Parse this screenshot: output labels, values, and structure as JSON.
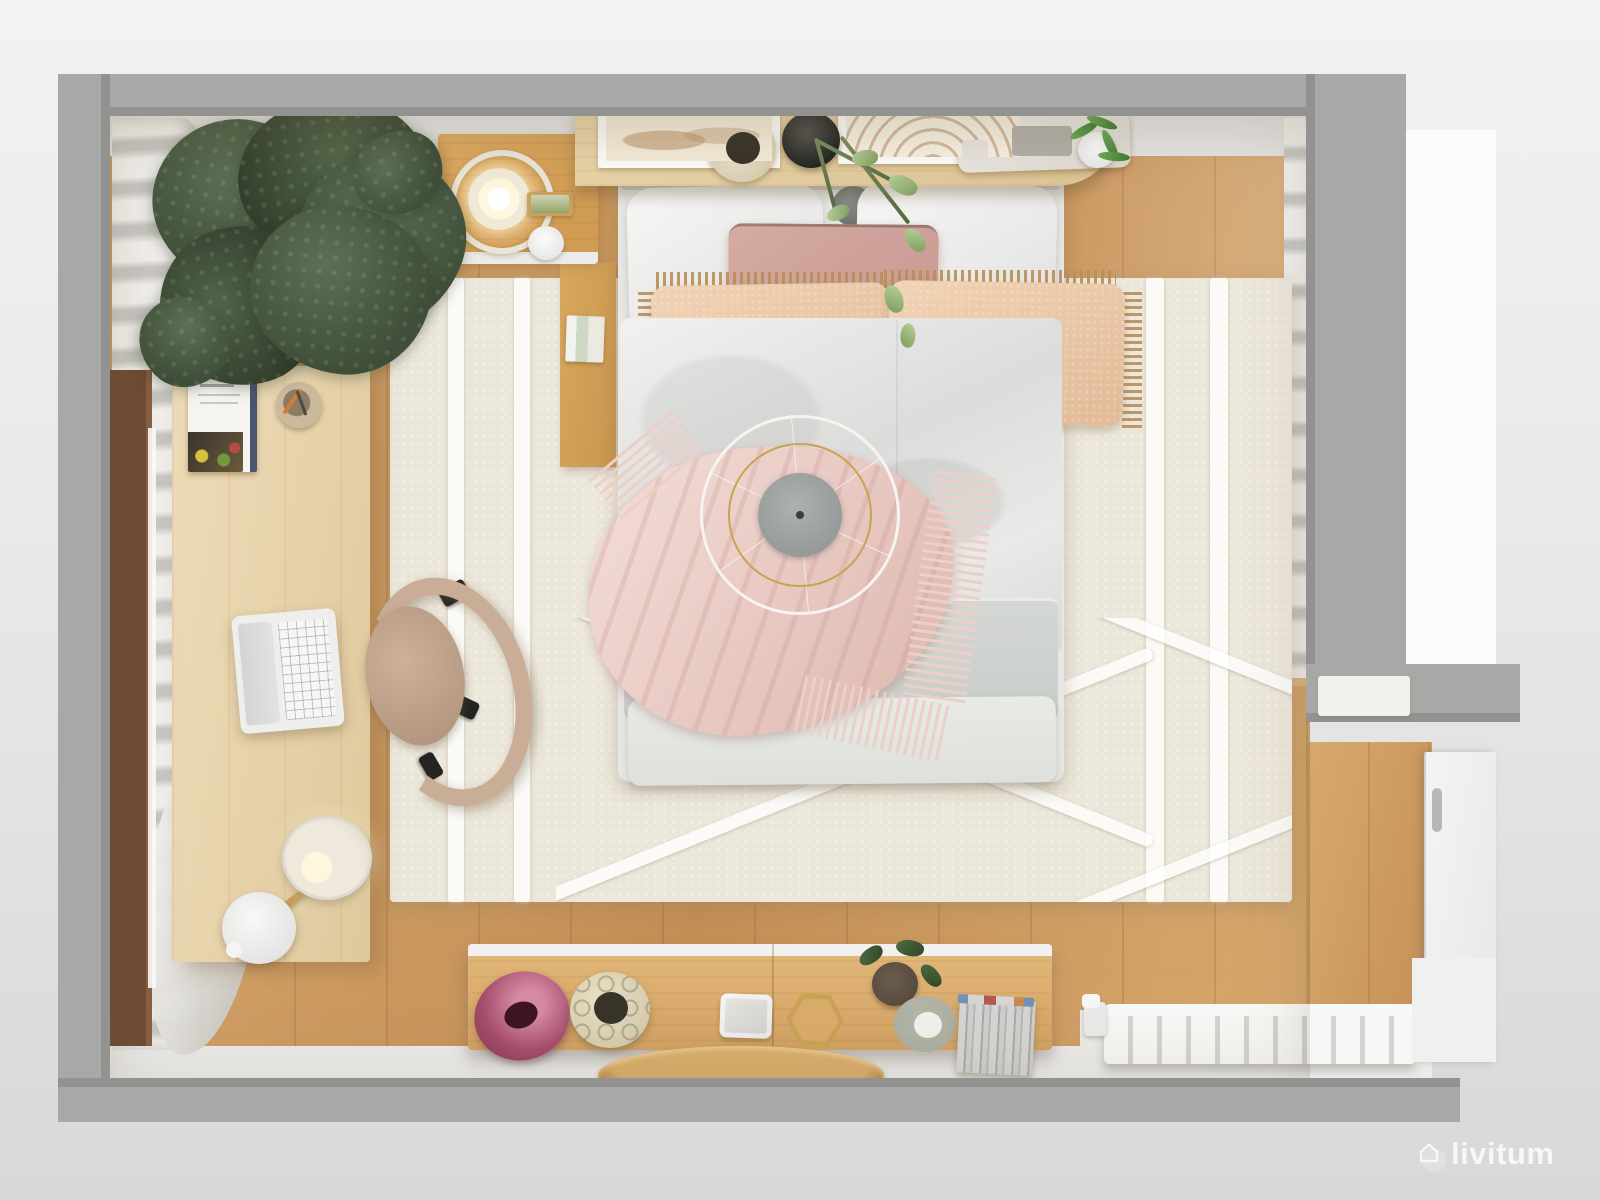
{
  "watermark": {
    "brand": "livitum",
    "icon": "house-outline-icon"
  },
  "scene": {
    "description": "Top-down 3D render of a scandinavian-style bedroom",
    "objects": [
      "potted-olive-tree",
      "left-window-with-curtain",
      "wood-nightstand-with-glass-lamp",
      "headboard-shelf-with-art-prints-and-plants",
      "double-bed-with-pillows",
      "pink-throw-blanket",
      "ceiling-pendant-lamp",
      "cream-rug-with-diamond-pattern",
      "work-desk-with-laptop-and-cookbook",
      "office-chair",
      "floor-lamp",
      "sideboard-with-vases-and-books",
      "round-wood-tray",
      "white-radiator",
      "white-door"
    ]
  },
  "colors": {
    "bg_top": "#f2f2f0",
    "bg_mid": "#e8e8e6",
    "bg_bottom": "#d8d8d6",
    "bright_panel": "#fbfbf9",
    "wall": "#a8a8a6",
    "wall_edge": "#929290",
    "top_wall_face": "#e5e3e1",
    "white_strip": "#ecebe9",
    "sill": "#f2f0ed",
    "floor_a": "#d7a96e",
    "floor_b": "#c38e56",
    "plank": "rgba(110,65,25,0.16)",
    "rug": "#ece7db",
    "rug_dot": "rgba(255,255,255,0.5)",
    "rug_stripe": "rgba(255,255,255,0.78)",
    "curtain_a": "#f1efeb",
    "curtain_b": "#c8c6c2",
    "walnut": "#6e4c35",
    "walnut_light": "#8a5f41",
    "glow": "#fcfcfa",
    "leaf_a": "#5d7054",
    "leaf_b": "#3f4e38",
    "basket": "#c4aa7e",
    "basket_hole": "#3a3126",
    "shelf": "#e7d3a8",
    "nightstand": "#dcaa62",
    "wood_side": "#d9a85f",
    "ring": "#e9e4d8",
    "dome": "#f0e9d6",
    "glow_warm": "#fff7dd",
    "frame_tan": "#caa25c",
    "pillow": "#f6f6f4",
    "pillow_dk": "#e0e0de",
    "mauve": "#d5aba3",
    "mauve_dk": "#c3948c",
    "blush": "#f1d3b5",
    "blush_dk": "#e2bb98",
    "fringe": "#b98e57",
    "boho": "#f0e8d6",
    "boho_line": "#4c4c48",
    "duvet_a": "#f1f1ef",
    "duvet_b": "#dcdcda",
    "blanket": "#d4d7d3",
    "sheet": "#e8eae6",
    "throw_a": "#f4ded8",
    "throw_b": "#e3c2ba",
    "throw_fringe": "#eccfc8",
    "ring_white": "#f6f4f0",
    "gold": "#c9a254",
    "disc_a": "#adb2b0",
    "disc_b": "#8c918f",
    "dot": "#3c3c3a",
    "desk_a": "#eedcb8",
    "desk_b": "#dfc89d",
    "laptop": "#eeeeec",
    "screen": "#d4d4d2",
    "keys": "rgba(130,130,128,0.45)",
    "chair": "#c9ad96",
    "chair_dk": "#ad9079",
    "black": "#232321",
    "board_a": "#e3b87a",
    "board_b": "#d2a263",
    "disc_vase_a": "#d489a4",
    "disc_vase_b": "#a84e6e",
    "disc_hole": "#3f1524",
    "cream_vase": "#e9e0c6",
    "cream_vase_dk": "#cfc4a4",
    "vase_hole": "#39342a",
    "plate": "#a9ac9e",
    "pot": "#51453a",
    "book_gray": "#d6d5d3",
    "book_dk": "#abaaa8",
    "book_red": "#b4574e",
    "book_blue": "#7291b5",
    "book_tan": "#c58a52",
    "tray_a": "#d9ae6c",
    "tray_b": "#ab7e3e",
    "radiator": "#f6f6f4",
    "rad_gap": "#d2d2d0",
    "door": "#f4f4f2",
    "handle": "#b7b7b5",
    "wm": "#fdfdfd"
  }
}
